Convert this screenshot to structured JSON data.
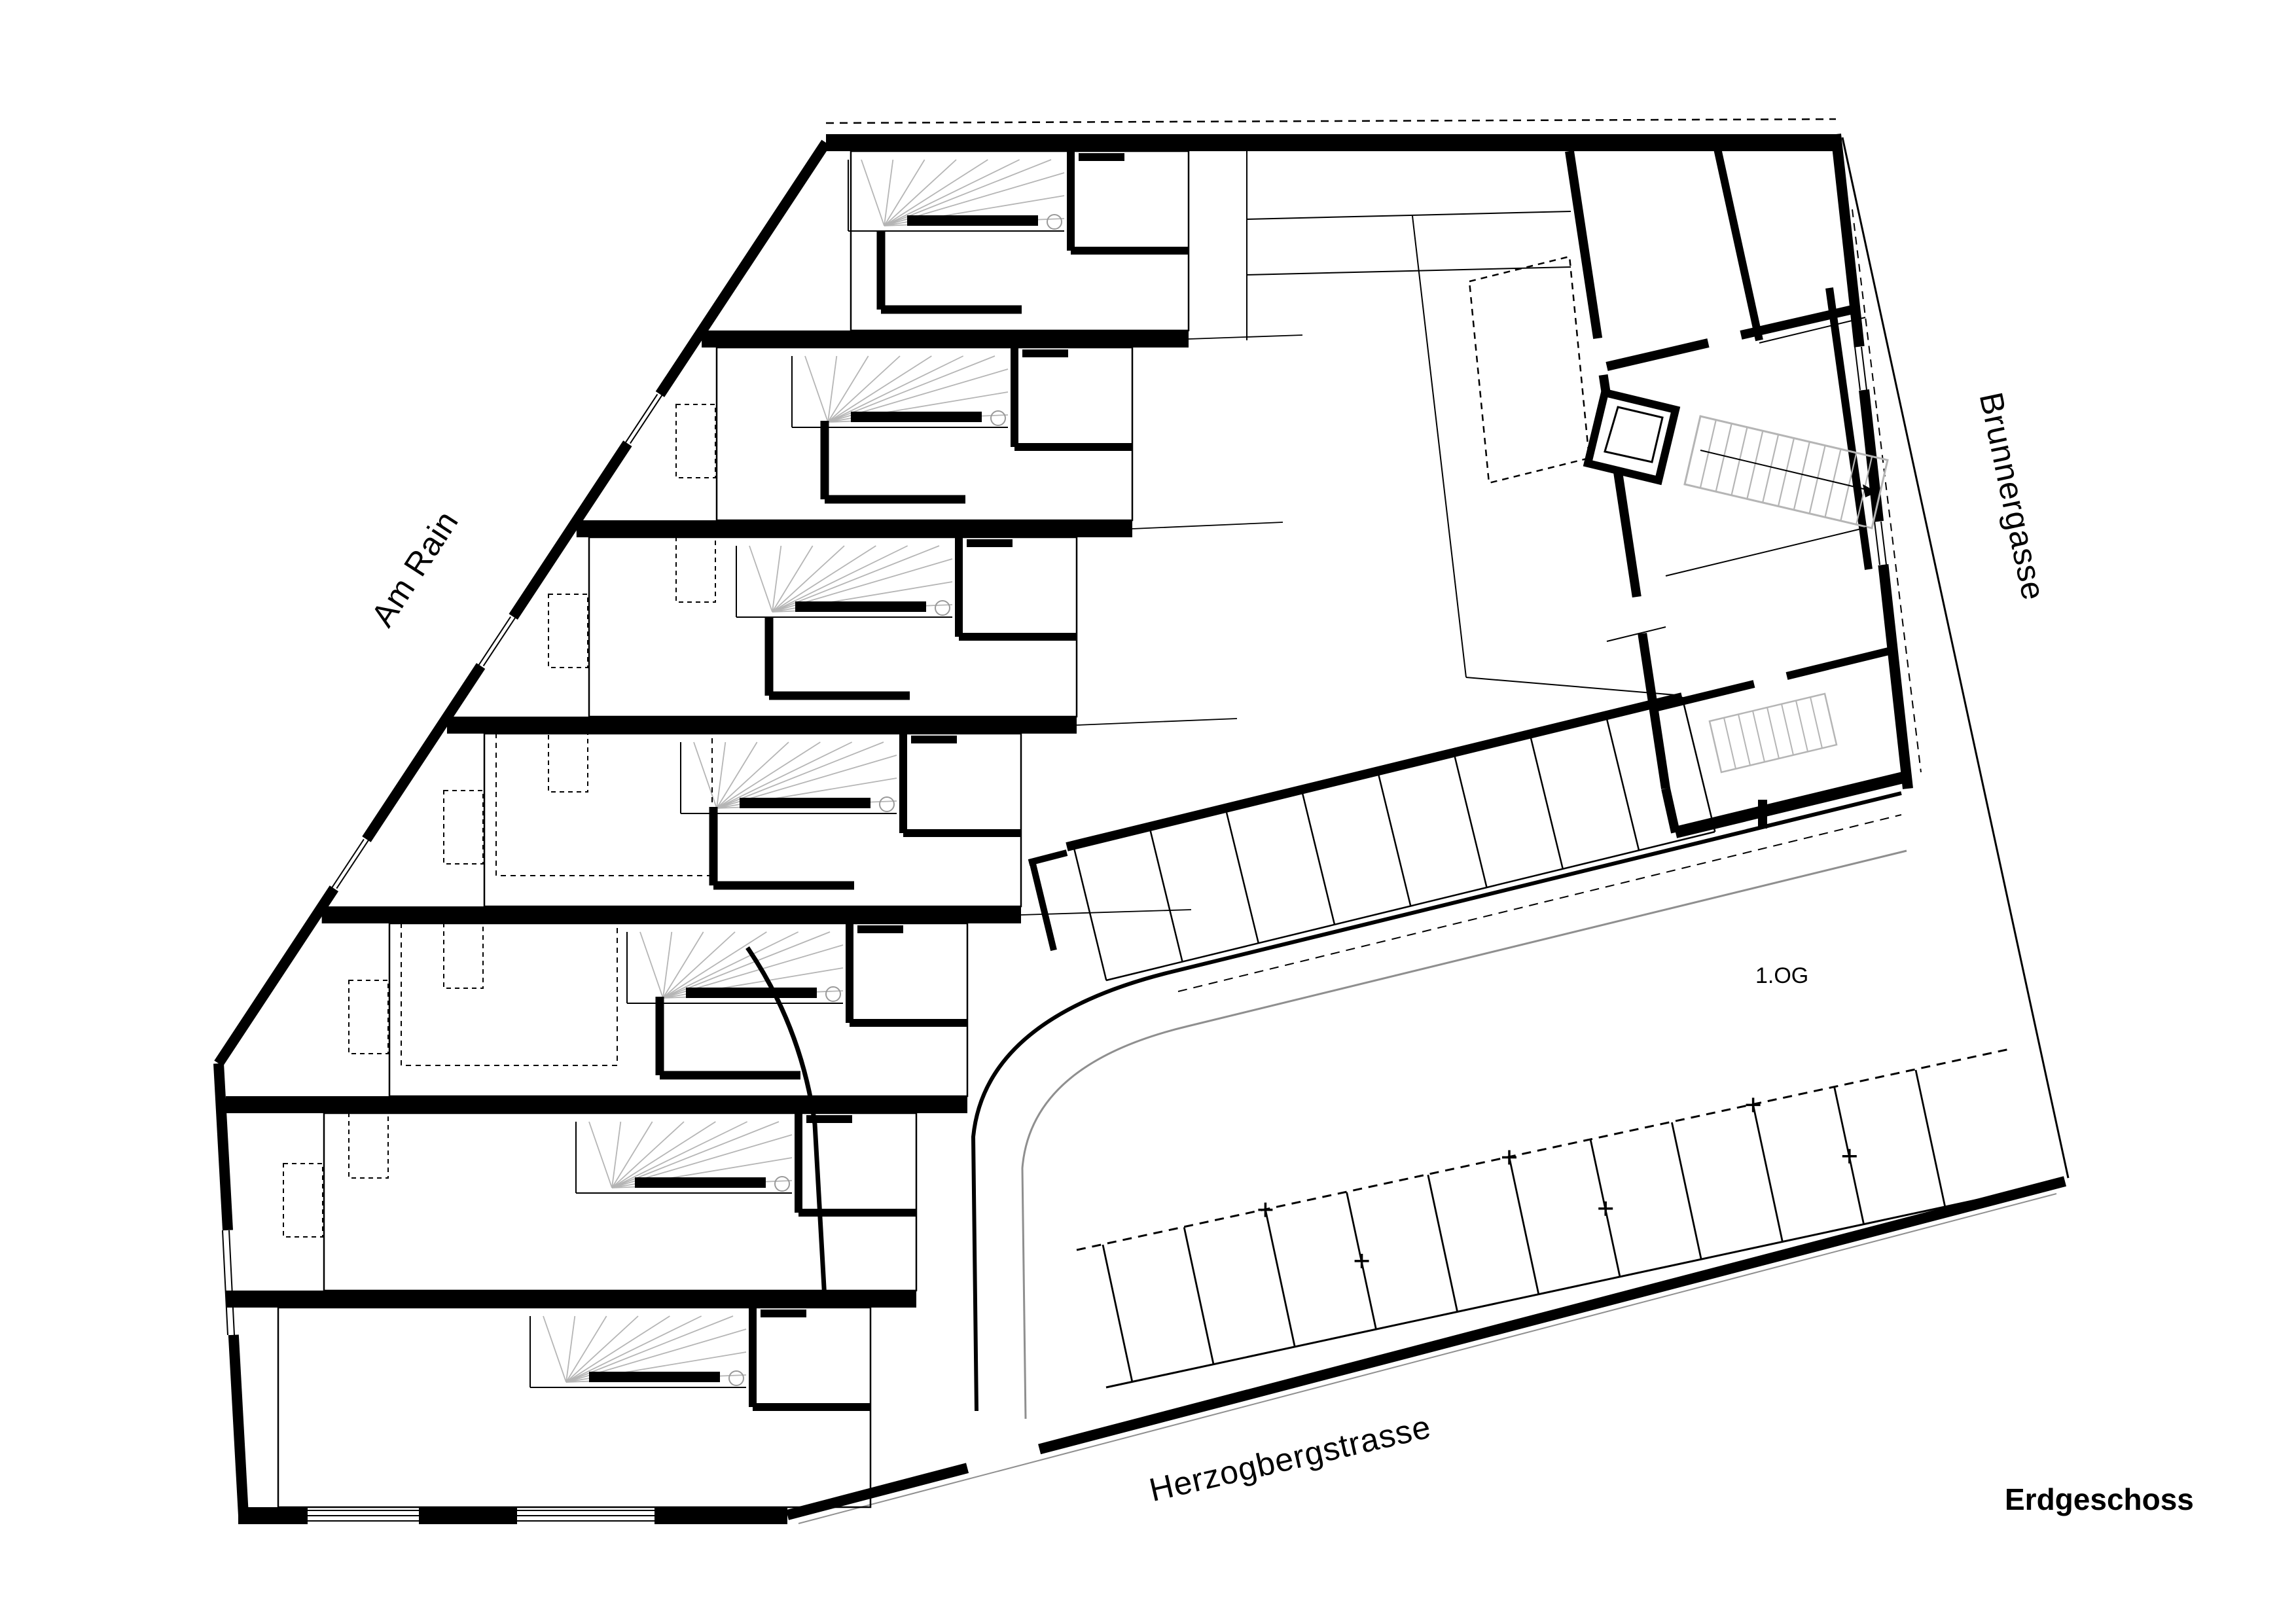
{
  "document": {
    "type": "architectural-floor-plan",
    "drawing_style": "black-and-white line drawing, thick poché walls"
  },
  "labels": {
    "floor_title": "Erdgeschoss",
    "upper_floor_note": "1.OG",
    "street_top_left": "Am Rain",
    "street_right": "Brunnergasse",
    "street_bottom": "Herzogbergstrasse"
  },
  "colors": {
    "ink": "#000000",
    "stair_gray": "#b5b5b5",
    "road_gray": "#8f8f8f",
    "background": "#ffffff"
  }
}
